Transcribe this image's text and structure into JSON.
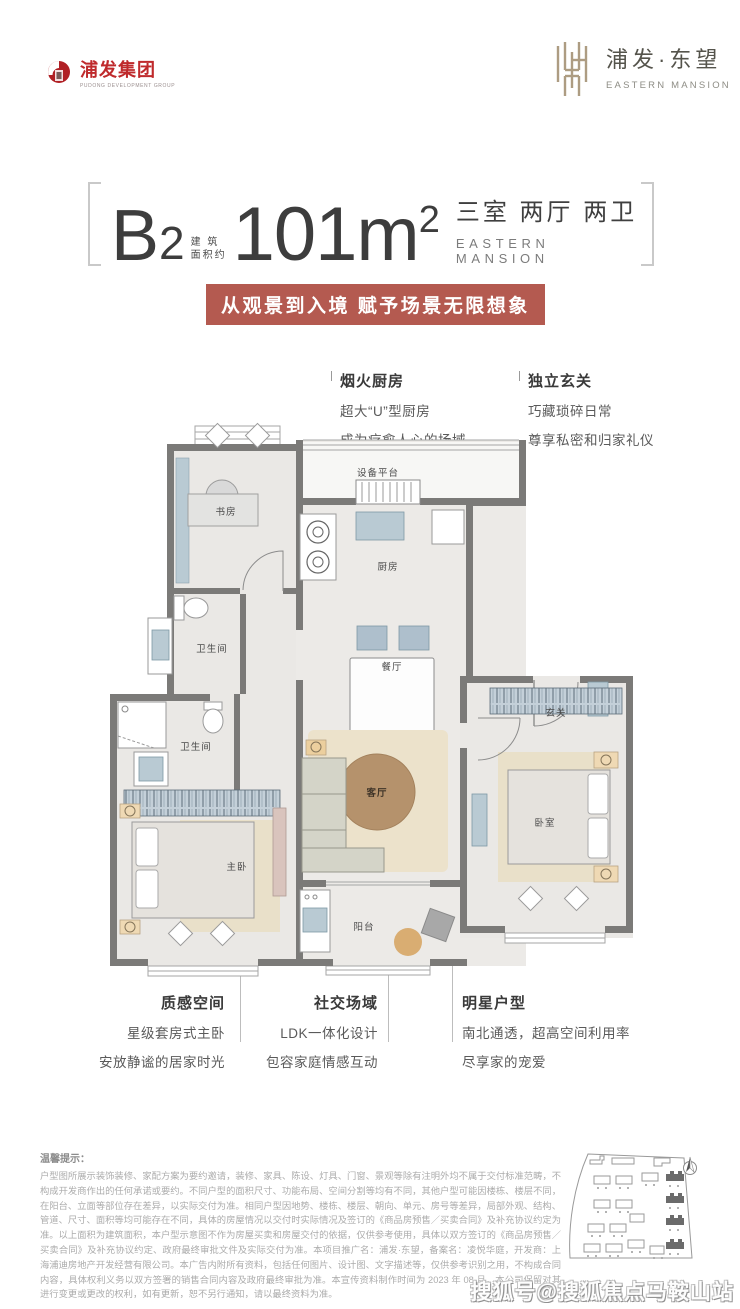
{
  "header": {
    "group": {
      "name": "浦发集团",
      "tagline": "PUDONG DEVELOPMENT GROUP"
    },
    "project": {
      "name": "浦发·东望",
      "name_en": "EASTERN MANSION"
    }
  },
  "title": {
    "unit": "B",
    "unit_no": "2",
    "area_label_1": "建 筑",
    "area_label_2": "面积约",
    "area": "101m",
    "area_sup": "2",
    "layout": "三室 两厅 两卫",
    "layout_en": "EASTERN MANSION"
  },
  "banner": {
    "text": "从观景到入境 赋予场景无限想象"
  },
  "callouts": {
    "kitchen": {
      "title": "烟火厨房",
      "line1": "超大“U”型厨房",
      "line2": "成为疗愈人心的场域"
    },
    "foyer": {
      "title": "独立玄关",
      "line1": "巧藏琐碎日常",
      "line2": "尊享私密和归家礼仪"
    },
    "master": {
      "title": "质感空间",
      "line1": "星级套房式主卧",
      "line2": "安放静谧的居家时光"
    },
    "social": {
      "title": "社交场域",
      "line1": "LDK一体化设计",
      "line2": "包容家庭情感互动"
    },
    "star": {
      "title": "明星户型",
      "line1": "南北通透，超高空间利用率",
      "line2": "尽享家的宠爱"
    }
  },
  "plan": {
    "rooms": {
      "study": "书房",
      "equipment": "设备平台",
      "kitchen": "厨房",
      "dining": "餐厅",
      "bath1": "卫生间",
      "bath2": "卫生间",
      "master": "主卧",
      "living": "客厅",
      "foyer": "玄关",
      "bedroom": "卧室",
      "balcony": "阳台"
    }
  },
  "disclaimer": {
    "title": "温馨提示：",
    "body": "户型图所展示装饰装修、家配方案为要约邀请，装修、家具、陈设、灯具、门窗、景观等除有注明外均不属于交付标准范畴，不构成开发商作出的任何承诺或要约。不同户型的面积尺寸、功能布局、空间分割等均有不同，其他户型可能因楼栋、楼层不同，在阳台、立面等部位存在差异，以实际交付为准。相同户型因地势、楼栋、楼层、朝向、单元、房号等差异，局部外观、结构、管道、尺寸、面积等均可能存在不同，具体的房屋情况以交付时实际情况及签订的《商品房预售／买卖合同》及补充协议约定为准。以上面积为建筑面积，本户型示意图不作为房屋买卖和房屋交付的依据，仅供参考使用，具体以双方签订的《商品房预售／买卖合同》及补充协议约定、政府最终审批文件及实际交付为准。本项目推广名：浦发·东望，备案名：凌悦华庭，开发商：上海浦迪房地产开发经营有限公司。本广告内附所有资料，包括任何图片、设计图、文字描述等，仅供参考识别之用，不构成合同内容，具体权利义务以双方签署的销售合同内容及政府最终审批为准。本宣传资料制作时间为 2023 年 08 月，本公司保留对其进行变更或更改的权利，如有更新，恕不另行通知，请以最终资料为准。"
  },
  "watermark": "搜狐号@搜狐焦点马鞍山站",
  "colors": {
    "banner": "#b45a50",
    "logo_red": "#bf2a2c",
    "gold": "#ad9c82",
    "wall": "#7b7a78"
  }
}
